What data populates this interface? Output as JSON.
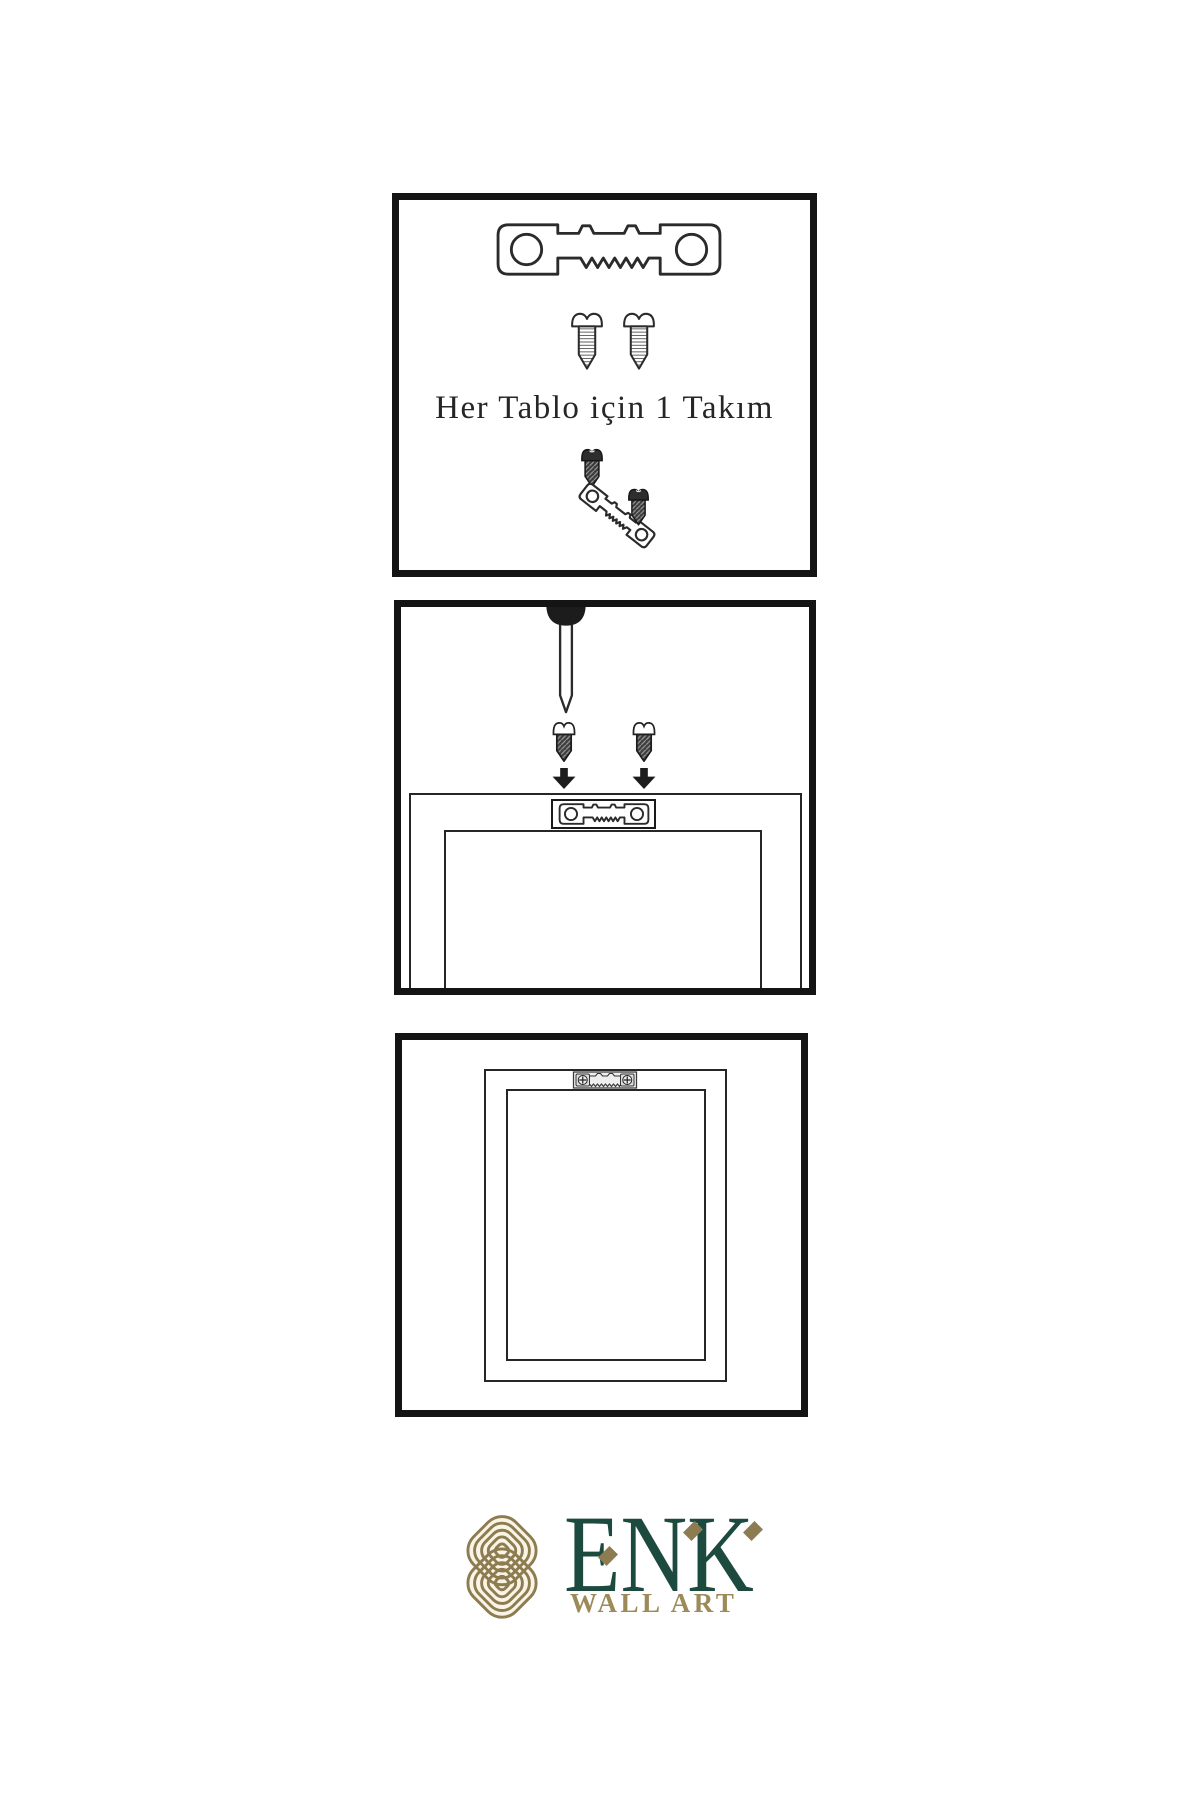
{
  "colors": {
    "line": "#2b2b2b",
    "panel_border": "#141414",
    "metal_dark": "#3e3e3e",
    "logo_green": "#1d4a3e",
    "logo_gold": "#8d7c50",
    "logo_gold_light": "#9c8a59",
    "emblem_bg": "#f9f4e6"
  },
  "step1": {
    "caption": "Her Tablo için 1 Takım"
  },
  "logo": {
    "brand": "ENK",
    "subtitle": "WALL ART"
  },
  "icons": {
    "sawtooth-hanger": "metal sawtooth hanging bracket with two holes",
    "screw-outline": "slotted screw, threaded shaft",
    "screw-dark": "dark screw with diagonal threads",
    "nail": "nail driven down from top edge",
    "arrow-down": "solid black downward arrow",
    "mounted-bracket": "sawtooth bracket fixed with two cross screws",
    "knot-emblem": "interwoven gold knot emblem"
  }
}
